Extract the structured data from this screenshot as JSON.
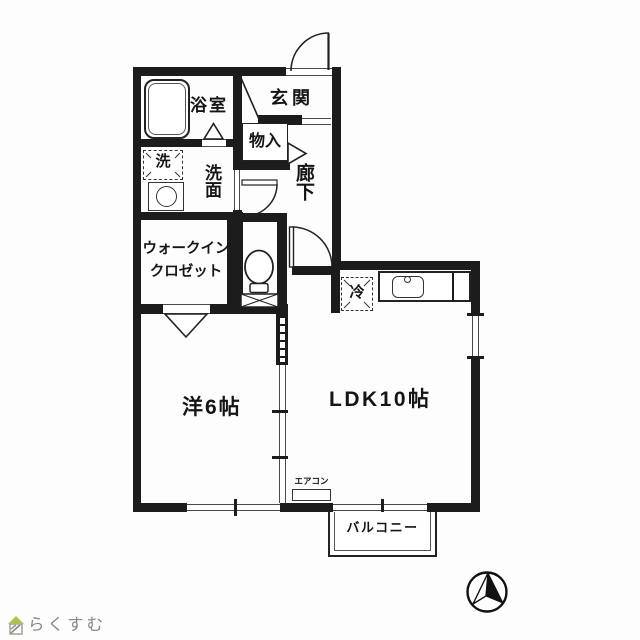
{
  "floorplan": {
    "rooms": {
      "bathroom": {
        "label": "浴室"
      },
      "entrance": {
        "label": "玄関"
      },
      "storage": {
        "label": "物入"
      },
      "hallway": {
        "label": "廊下"
      },
      "washer": {
        "label": "洗"
      },
      "washroom": {
        "label": "洗面"
      },
      "wic": {
        "label_line1": "ウォークイン",
        "label_line2": "クロゼット"
      },
      "fridge": {
        "label": "冷"
      },
      "bedroom": {
        "label": "洋6帖"
      },
      "ldk": {
        "label": "LDK10帖"
      },
      "aircon": {
        "label": "エアコン"
      },
      "balcony": {
        "label": "バルコニー"
      }
    },
    "fixtures": [
      "bathtub",
      "washing-machine",
      "toilet",
      "kitchen-sink",
      "refrigerator",
      "air-conditioner",
      "north-arrow",
      "house-logo"
    ],
    "colors": {
      "wall": "#1c1c1c",
      "line": "#2a2a2a"
    }
  },
  "footer": {
    "logo_text": "らくすむ",
    "logo_text_color": "#8e8780",
    "logo_roof_color": "#b5bf4e"
  }
}
